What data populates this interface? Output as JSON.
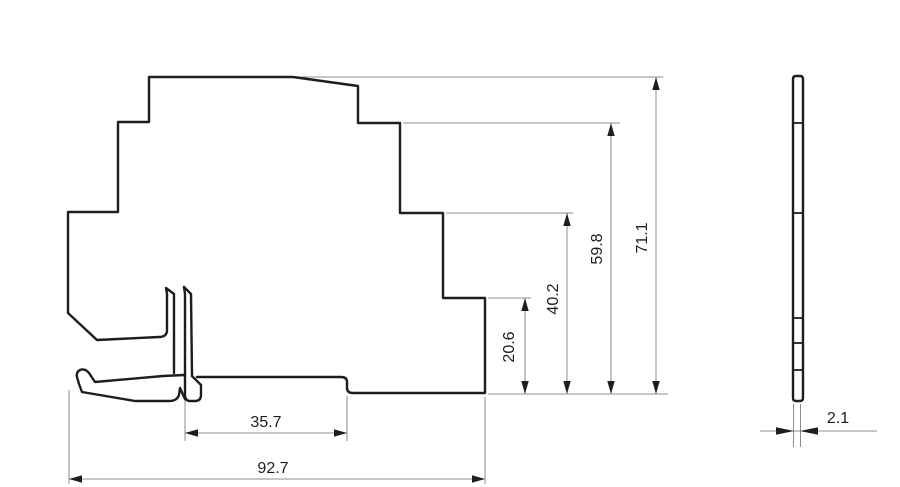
{
  "drawing": {
    "type": "technical-dimension-drawing",
    "colors": {
      "background": "#ffffff",
      "outline": "#1d1d1b",
      "dimension_lines": "#8c8c8c",
      "text": "#1d1d1b"
    },
    "dims": {
      "overall_width": "92.7",
      "din_slot_width": "35.7",
      "step1_height": "20.6",
      "step2_height": "40.2",
      "step3_height": "59.8",
      "overall_height": "71.1",
      "profile_thickness": "2.1"
    }
  }
}
